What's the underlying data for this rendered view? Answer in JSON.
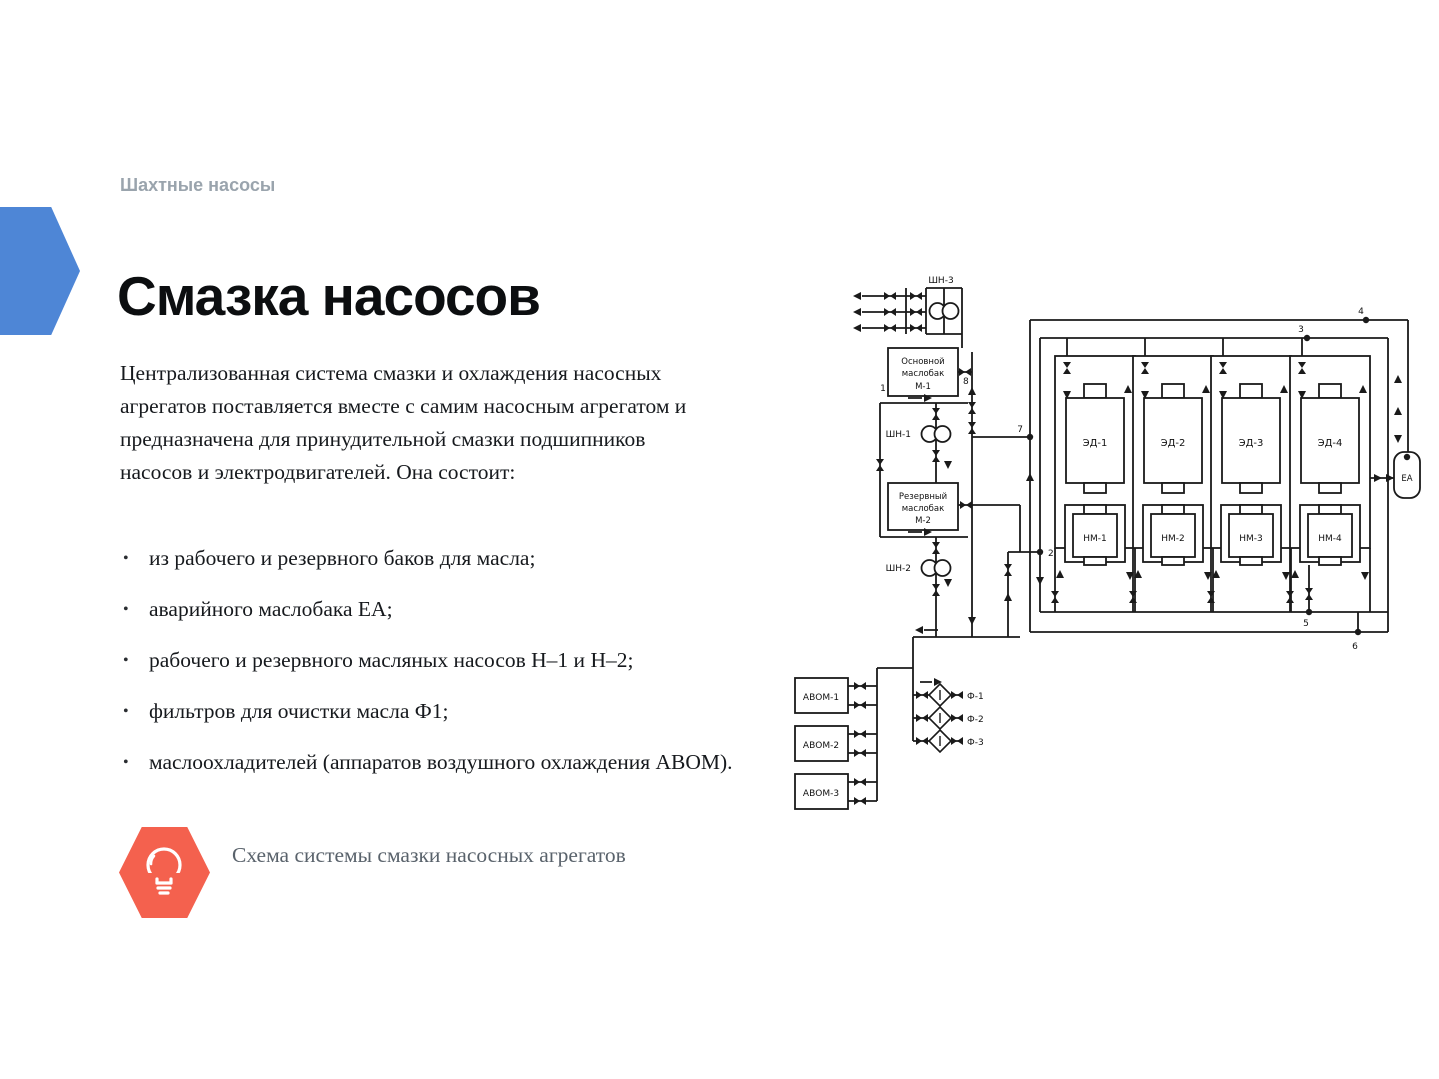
{
  "slide": {
    "kicker": "Шахтные насосы",
    "title": "Смазка насосов",
    "paragraph": "Централизованная система смазки и охлаждения насосных агрегатов поставляется вместе с самим насосным агрегатом и предназначена для принудительной смазки подшипников насосов и электродвигателей. Она состоит:",
    "bullet_char": "•",
    "bullets": [
      "из рабочего и резервного баков для масла;",
      "аварийного маслобака ЕА;",
      "рабочего и резервного масляных насосов Н–1 и Н–2;",
      "фильтров для очистки масла Ф1;",
      "маслоохладителей (аппаратов воздушного охлаждения АВОМ)."
    ],
    "note": {
      "icon": "lightbulb-icon",
      "text": "Схема системы смазки насосных агрегатов"
    },
    "colors": {
      "accent_blue": "#4e86d6",
      "accent_orange": "#f4614e",
      "kicker_gray": "#9aa4ad",
      "body_text": "#16191d",
      "caption_gray": "#59626b",
      "diagram_ink": "#1a1a1a"
    }
  },
  "diagram": {
    "labels": {
      "shn3": "ШН-3",
      "shn1": "ШН-1",
      "shn2": "ШН-2",
      "m1_line1": "Основной",
      "m1_line2": "маслобак",
      "m1_line3": "М-1",
      "m2_line1": "Резервный",
      "m2_line2": "маслобак",
      "m2_line3": "М-2",
      "avom1": "АВОМ-1",
      "avom2": "АВОМ-2",
      "avom3": "АВОМ-3",
      "f1": "Ф-1",
      "f2": "Ф-2",
      "f3": "Ф-3",
      "ed1": "ЭД-1",
      "ed2": "ЭД-2",
      "ed3": "ЭД-3",
      "ed4": "ЭД-4",
      "nm1": "НМ-1",
      "nm2": "НМ-2",
      "nm3": "НМ-3",
      "nm4": "НМ-4",
      "ea": "ЕА",
      "j1": "1",
      "j2": "2",
      "j3": "3",
      "j4": "4",
      "j5": "5",
      "j6": "6",
      "j7": "7",
      "j8": "8"
    }
  }
}
